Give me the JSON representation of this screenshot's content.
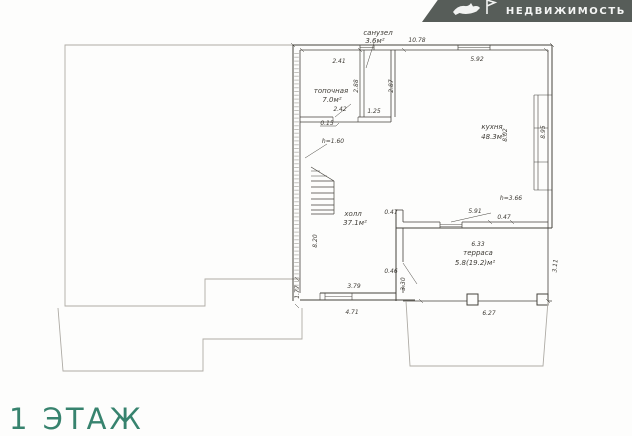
{
  "watermark": {
    "brand": "НЕДВИЖИМОСТЬ"
  },
  "floor_label": "1 ЭТАЖ",
  "plan": {
    "rooms": [
      {
        "name": "санузел",
        "area": "3.6м²"
      },
      {
        "name": "топочная",
        "area": "7.0м²"
      },
      {
        "name": "кухня",
        "area": "48.3м²"
      },
      {
        "name": "холл",
        "area": "37.1м²"
      },
      {
        "name": "терраса",
        "area": "5.8(19.2)м²"
      }
    ],
    "heights": {
      "under_stairs": "h=1.60",
      "main": "h=3.66"
    },
    "dims": {
      "top": "10.78",
      "boiler_top": "2.41",
      "kitchen_top": "5.92",
      "boiler_height": "2.88",
      "bath_height": "2.87",
      "boiler_width": "2.42",
      "bath_width": "1.25",
      "wall_offset": "0.15",
      "right_inner": "8.02",
      "right_outer": "8.95",
      "hall_left": "8.20",
      "hall_nub": "0.47",
      "kitchen_bottom": "5.91",
      "kitchen_nub": "0.47",
      "terrace_top": "6.33",
      "door_nub": "0.46",
      "terrace_left": "3.30",
      "hall_bottom_inner": "3.79",
      "hall_bottom_outer": "4.71",
      "terrace_bottom": "6.27",
      "terrace_right": "3.11",
      "plot_step": "1.77"
    }
  },
  "colors": {
    "banner_bg": "#575d59",
    "accent_teal": "#37836e",
    "wall_line": "#45423c",
    "faint_line": "#aeaba5"
  }
}
